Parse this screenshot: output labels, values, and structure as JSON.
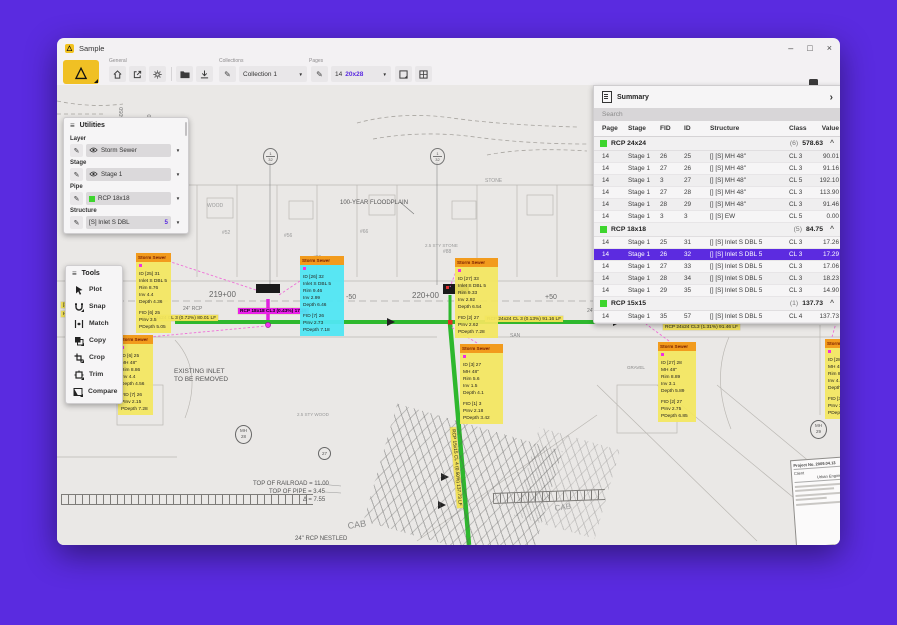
{
  "window": {
    "title": "Sample"
  },
  "icons": {
    "hamburger": "≡",
    "dropdown": "▼",
    "chevron": "›",
    "caret": "^",
    "pencil": "✎",
    "minimize": "–",
    "maximize": "□",
    "close": "×",
    "logo": "△"
  },
  "toolbar": {
    "groups": [
      {
        "label": "General"
      },
      {
        "label": "Collections"
      },
      {
        "label": "Pages"
      }
    ],
    "collection_value": "Collection 1",
    "page_number": "14",
    "page_size": "20x28"
  },
  "utilities": {
    "title": "Utilities",
    "sections": [
      {
        "label": "Layer",
        "type": "eye",
        "value": "Storm Sewer"
      },
      {
        "label": "Stage",
        "type": "eye",
        "value": "Stage 1"
      },
      {
        "label": "Pipe",
        "type": "swatch",
        "value": "RCP 18x18",
        "swatch": "#3ed52e"
      },
      {
        "label": "Structure",
        "type": "plain",
        "value": "[S] Inlet S DBL",
        "badge": "5"
      }
    ]
  },
  "tools": {
    "title": "Tools",
    "items": [
      {
        "label": "Plot",
        "icon": "plot",
        "fold": false
      },
      {
        "label": "Snap",
        "icon": "snap",
        "fold": true
      },
      {
        "label": "Match",
        "icon": "match",
        "fold": false
      },
      {
        "label": "Copy",
        "icon": "copy",
        "fold": true
      },
      {
        "label": "Crop",
        "icon": "crop",
        "fold": true
      },
      {
        "label": "Trim",
        "icon": "trim",
        "fold": true
      },
      {
        "label": "Compare",
        "icon": "compare",
        "fold": true
      }
    ]
  },
  "summary": {
    "title": "Summary",
    "search_placeholder": "Search",
    "columns": [
      "Page",
      "Stage",
      "FID",
      "ID",
      "Structure",
      "Class",
      "Value"
    ],
    "groups": [
      {
        "name": "RCP 24x24",
        "count": "(6)",
        "total": "578.63",
        "color": "#3ed52e",
        "rows": [
          [
            "14",
            "Stage 1",
            "26",
            "25",
            "[] [S] MH 48\"",
            "CL 3",
            "90.01"
          ],
          [
            "14",
            "Stage 1",
            "27",
            "26",
            "[] [S] MH 48\"",
            "CL 3",
            "91.16"
          ],
          [
            "14",
            "Stage 1",
            "3",
            "27",
            "[] [S] MH 48\"",
            "CL 5",
            "192.10"
          ],
          [
            "14",
            "Stage 1",
            "27",
            "28",
            "[] [S] MH 48\"",
            "CL 3",
            "113.90"
          ],
          [
            "14",
            "Stage 1",
            "28",
            "29",
            "[] [S] MH 48\"",
            "CL 3",
            "91.46"
          ],
          [
            "14",
            "Stage 1",
            "3",
            "3",
            "[] [S] EW",
            "CL 5",
            "0.00"
          ]
        ]
      },
      {
        "name": "RCP 18x18",
        "count": "(5)",
        "total": "84.75",
        "color": "#3ed52e",
        "rows": [
          [
            "14",
            "Stage 1",
            "25",
            "31",
            "[] [S] Inlet S DBL 5",
            "CL 3",
            "17.26"
          ],
          [
            "14",
            "Stage 1",
            "26",
            "32",
            "[] [S] Inlet S DBL 5",
            "CL 3",
            "17.29"
          ],
          [
            "14",
            "Stage 1",
            "27",
            "33",
            "[] [S] Inlet S DBL 5",
            "CL 3",
            "17.06"
          ],
          [
            "14",
            "Stage 1",
            "28",
            "34",
            "[] [S] Inlet S DBL 5",
            "CL 3",
            "18.23"
          ],
          [
            "14",
            "Stage 1",
            "29",
            "35",
            "[] [S] Inlet S DBL 5",
            "CL 3",
            "14.90"
          ]
        ]
      },
      {
        "name": "RCP 15x15",
        "count": "(1)",
        "total": "137.73",
        "color": "#3ed52e",
        "rows": [
          [
            "14",
            "Stage 1",
            "35",
            "57",
            "[] [S] Inlet S DBL 5",
            "CL 4",
            "137.73"
          ]
        ]
      }
    ],
    "selected": {
      "group": 1,
      "row": 1
    }
  },
  "callouts": [
    {
      "type": "yellow",
      "x": 79,
      "y": 168,
      "w": 35,
      "header": "Storm Sewer",
      "lines": [
        "ID [25] 31",
        "Inlet S DBL 5",
        "Rim 8.76",
        "Inv 4.4",
        "Depth 4.36",
        "",
        "FID [6] 25",
        "PInv 3.5",
        "PDepth 5.05"
      ]
    },
    {
      "type": "yellow",
      "x": 61,
      "y": 250,
      "w": 35,
      "header": "Storm Sewer",
      "lines": [
        "ID [6] 25",
        "MH 48\"",
        "Rim 8.86",
        "Inv 4.4",
        "Depth 4.56",
        "",
        "FID [7] 26",
        "PInv 2.15",
        "PDepth 7.28"
      ]
    },
    {
      "type": "cyan",
      "x": 243,
      "y": 171,
      "w": 44,
      "header": "Storm Sewer",
      "lines": [
        "ID [26] 32",
        "Inlet S DBL 5",
        "Rim 9.46",
        "Inv 2.99",
        "Depth 6.46",
        "",
        "FID [7] 26",
        "PInv 2.73",
        "PDepth 7.18"
      ]
    },
    {
      "type": "yellow",
      "x": 398,
      "y": 173,
      "w": 43,
      "header": "Storm Sewer",
      "lines": [
        "ID [27] 33",
        "Inlet S DBL 5",
        "Rim 9.33",
        "Inv 2.92",
        "Depth 6.54",
        "",
        "FID [2] 27",
        "PInv 2.62",
        "PDepth 7.28"
      ]
    },
    {
      "type": "yellow",
      "x": 403,
      "y": 259,
      "w": 43,
      "header": "Storm Sewer",
      "lines": [
        "ID [3] 27",
        "MH 48\"",
        "Rim 5.6",
        "Inv 1.5",
        "Depth 4.1",
        "",
        "FID [1] 3",
        "PInv 2.18",
        "PDepth 3.42"
      ]
    },
    {
      "type": "yellow",
      "x": 601,
      "y": 257,
      "w": 38,
      "header": "Storm Sewer",
      "lines": [
        "ID [27] 28",
        "MH 48\"",
        "Rim 8.89",
        "Inv 3.1",
        "Depth 5.89",
        "",
        "FID [2] 27",
        "PInv 2.75",
        "PDepth 6.85"
      ]
    },
    {
      "type": "yellow",
      "x": 768,
      "y": 254,
      "w": 34,
      "header": "Storm Sewer",
      "lines": [
        "ID [28] 29",
        "MH 48\"",
        "Rim 8.9",
        "Inv 4.41",
        "Depth 4.49",
        "",
        "FID [3] 28",
        "PInv 3.2",
        "PDepth 5.79"
      ]
    }
  ],
  "pipe_labels": [
    {
      "text": "RCP 24x24 CL 3 (0.72%) 80.01 LF",
      "x": 83,
      "y": 230,
      "rot": 0,
      "style": "yellow"
    },
    {
      "text": "RCP 18x18 CL3 (0.43%) 17.29",
      "x": 181,
      "y": 223,
      "rot": 0,
      "style": "magenta"
    },
    {
      "text": "RCP 24x24 CL 3 (0.13%) 91.16 LF",
      "x": 428,
      "y": 231,
      "rot": 0,
      "style": "yellow"
    },
    {
      "text": "RCP 24x24 CL3 (1.31%) 91.46 LF",
      "x": 606,
      "y": 239,
      "rot": 0,
      "style": "yellow"
    },
    {
      "text": "RCP 18x18 CL4 (0.22%) 17.06 LF",
      "x": 676,
      "y": 216,
      "rot": -13,
      "style": "yellow"
    },
    {
      "text": "RCP 15x15 CL 4 (0.50%) 137.73 LF",
      "x": 399,
      "y": 342,
      "rot": 85,
      "style": "yellow"
    },
    {
      "text": "[S] 37.26 LF",
      "x": 4,
      "y": 217,
      "rot": 0,
      "style": "yellow"
    },
    {
      "text": "HW 5.2  PDepth 5.05",
      "x": 4,
      "y": 226,
      "rot": 0,
      "style": "yellow"
    },
    {
      "text": "Inv 3.27  PDepth 5.77",
      "x": 592,
      "y": 222,
      "rot": 0,
      "style": "yellow"
    }
  ],
  "canvas_texts": [
    {
      "text": "219+00",
      "x": 152,
      "y": 205,
      "size": 8,
      "color": "#666",
      "rot": 0
    },
    {
      "text": "-50",
      "x": 289,
      "y": 209,
      "size": 7,
      "color": "#666",
      "rot": 0
    },
    {
      "text": "220+00",
      "x": 355,
      "y": 206,
      "size": 8,
      "color": "#666",
      "rot": 0
    },
    {
      "text": "+50",
      "x": 488,
      "y": 209,
      "size": 7,
      "color": "#666",
      "rot": 0
    },
    {
      "text": "100-YEAR FLOODPLAIN",
      "x": 283,
      "y": 115,
      "size": 6,
      "color": "#555",
      "rot": 0
    },
    {
      "text": "TOP OF RAILROAD  =  11.00",
      "x": 196,
      "y": 396,
      "size": 6,
      "color": "#555",
      "rot": 0
    },
    {
      "text": "TOP OF PIPE  =  3.45",
      "x": 212,
      "y": 404,
      "size": 6,
      "color": "#555",
      "rot": 0
    },
    {
      "text": "Δ  =  7.55",
      "x": 246,
      "y": 412,
      "size": 6,
      "color": "#555",
      "rot": 0
    },
    {
      "text": "24\" RCP NESTLED",
      "x": 238,
      "y": 451,
      "size": 6,
      "color": "#555",
      "rot": 0
    },
    {
      "text": "EXISTING INLET",
      "x": 117,
      "y": 283,
      "size": 6.5,
      "color": "#555",
      "rot": 0
    },
    {
      "text": "TO BE REMOVED",
      "x": 117,
      "y": 291,
      "size": 6.5,
      "color": "#555",
      "rot": 0
    },
    {
      "text": "CAB",
      "x": 290,
      "y": 436,
      "size": 9,
      "color": "#8a8a8a",
      "rot": -8
    },
    {
      "text": "CAB",
      "x": 497,
      "y": 419,
      "size": 8,
      "color": "#9a9a9a",
      "rot": -8
    },
    {
      "text": "SAN",
      "x": 453,
      "y": 248,
      "size": 5,
      "color": "#888",
      "rot": 0
    },
    {
      "text": "GRAVEL",
      "x": 570,
      "y": 280,
      "size": 4.5,
      "color": "#888",
      "rot": 0
    },
    {
      "text": "#52",
      "x": 165,
      "y": 145,
      "size": 5,
      "color": "#999",
      "rot": 0
    },
    {
      "text": "#56",
      "x": 227,
      "y": 148,
      "size": 5,
      "color": "#999",
      "rot": 0
    },
    {
      "text": "#66",
      "x": 303,
      "y": 144,
      "size": 5,
      "color": "#999",
      "rot": 0
    },
    {
      "text": "#86",
      "x": 256,
      "y": 170,
      "size": 5,
      "color": "#999",
      "rot": 0
    },
    {
      "text": "#88",
      "x": 386,
      "y": 164,
      "size": 5,
      "color": "#999",
      "rot": 0
    },
    {
      "text": "#90",
      "x": 539,
      "y": 140,
      "size": 5,
      "color": "#999",
      "rot": 0
    },
    {
      "text": "N 736050",
      "x": 62,
      "y": 46,
      "size": 5.5,
      "color": "#777",
      "rot": -90
    },
    {
      "text": "E 1342050",
      "x": 90,
      "y": 56,
      "size": 5.5,
      "color": "#777",
      "rot": -90
    },
    {
      "text": "2.5 STY STONE",
      "x": 368,
      "y": 158,
      "size": 4.5,
      "color": "#999",
      "rot": 0
    },
    {
      "text": "2.5 STY WOOD",
      "x": 240,
      "y": 327,
      "size": 4.5,
      "color": "#999",
      "rot": 0
    },
    {
      "text": "WOOD",
      "x": 150,
      "y": 118,
      "size": 5,
      "color": "#999",
      "rot": 0
    },
    {
      "text": "STONE",
      "x": 428,
      "y": 93,
      "size": 5,
      "color": "#999",
      "rot": 0
    },
    {
      "text": "24\" RCP",
      "x": 126,
      "y": 221,
      "size": 5,
      "color": "#777",
      "rot": 0
    },
    {
      "text": "24\" RCP",
      "x": 530,
      "y": 223,
      "size": 5,
      "color": "#777",
      "rot": 0
    }
  ],
  "symbols": {
    "manholes": [
      {
        "line1": "MH",
        "line2": "28",
        "x": 178,
        "y": 340
      },
      {
        "line1": "MH",
        "line2": "29",
        "x": 753,
        "y": 335
      }
    ],
    "sections": [
      {
        "top": "1",
        "bottom": "32",
        "x": 206,
        "y": 63
      },
      {
        "top": "1",
        "bottom": "32",
        "x": 373,
        "y": 63
      }
    ],
    "station_marker": {
      "label": "27",
      "x": 261,
      "y": 362
    }
  },
  "titleblock": {
    "line1": "Project No. 2009.04.13",
    "line2": "Client",
    "line3": "Urban Engineering"
  }
}
